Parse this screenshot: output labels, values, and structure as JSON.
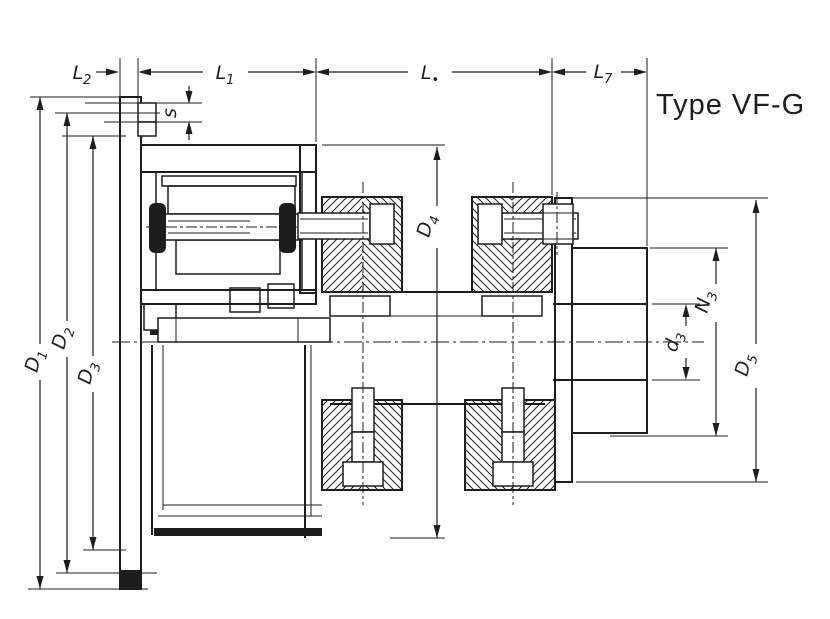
{
  "title": "Type VF-G",
  "drawing": {
    "dims": {
      "L2": {
        "main": "L",
        "sub": "2"
      },
      "L1": {
        "main": "L",
        "sub": "1"
      },
      "Ldot": {
        "main": "L",
        "sub": "•"
      },
      "L7": {
        "main": "L",
        "sub": "7"
      },
      "s": {
        "main": "s"
      },
      "D1": {
        "main": "D",
        "sub": "1"
      },
      "D2": {
        "main": "D",
        "sub": "2"
      },
      "D3": {
        "main": "D",
        "sub": "3"
      },
      "D4": {
        "main": "D",
        "sub": "4"
      },
      "d3": {
        "main": "d",
        "sub": "3"
      },
      "N3": {
        "main": "N",
        "sub": "3"
      },
      "D5": {
        "main": "D",
        "sub": "5"
      }
    },
    "colors": {
      "ink": "#1d1d1d",
      "paper": "#ffffff"
    }
  }
}
